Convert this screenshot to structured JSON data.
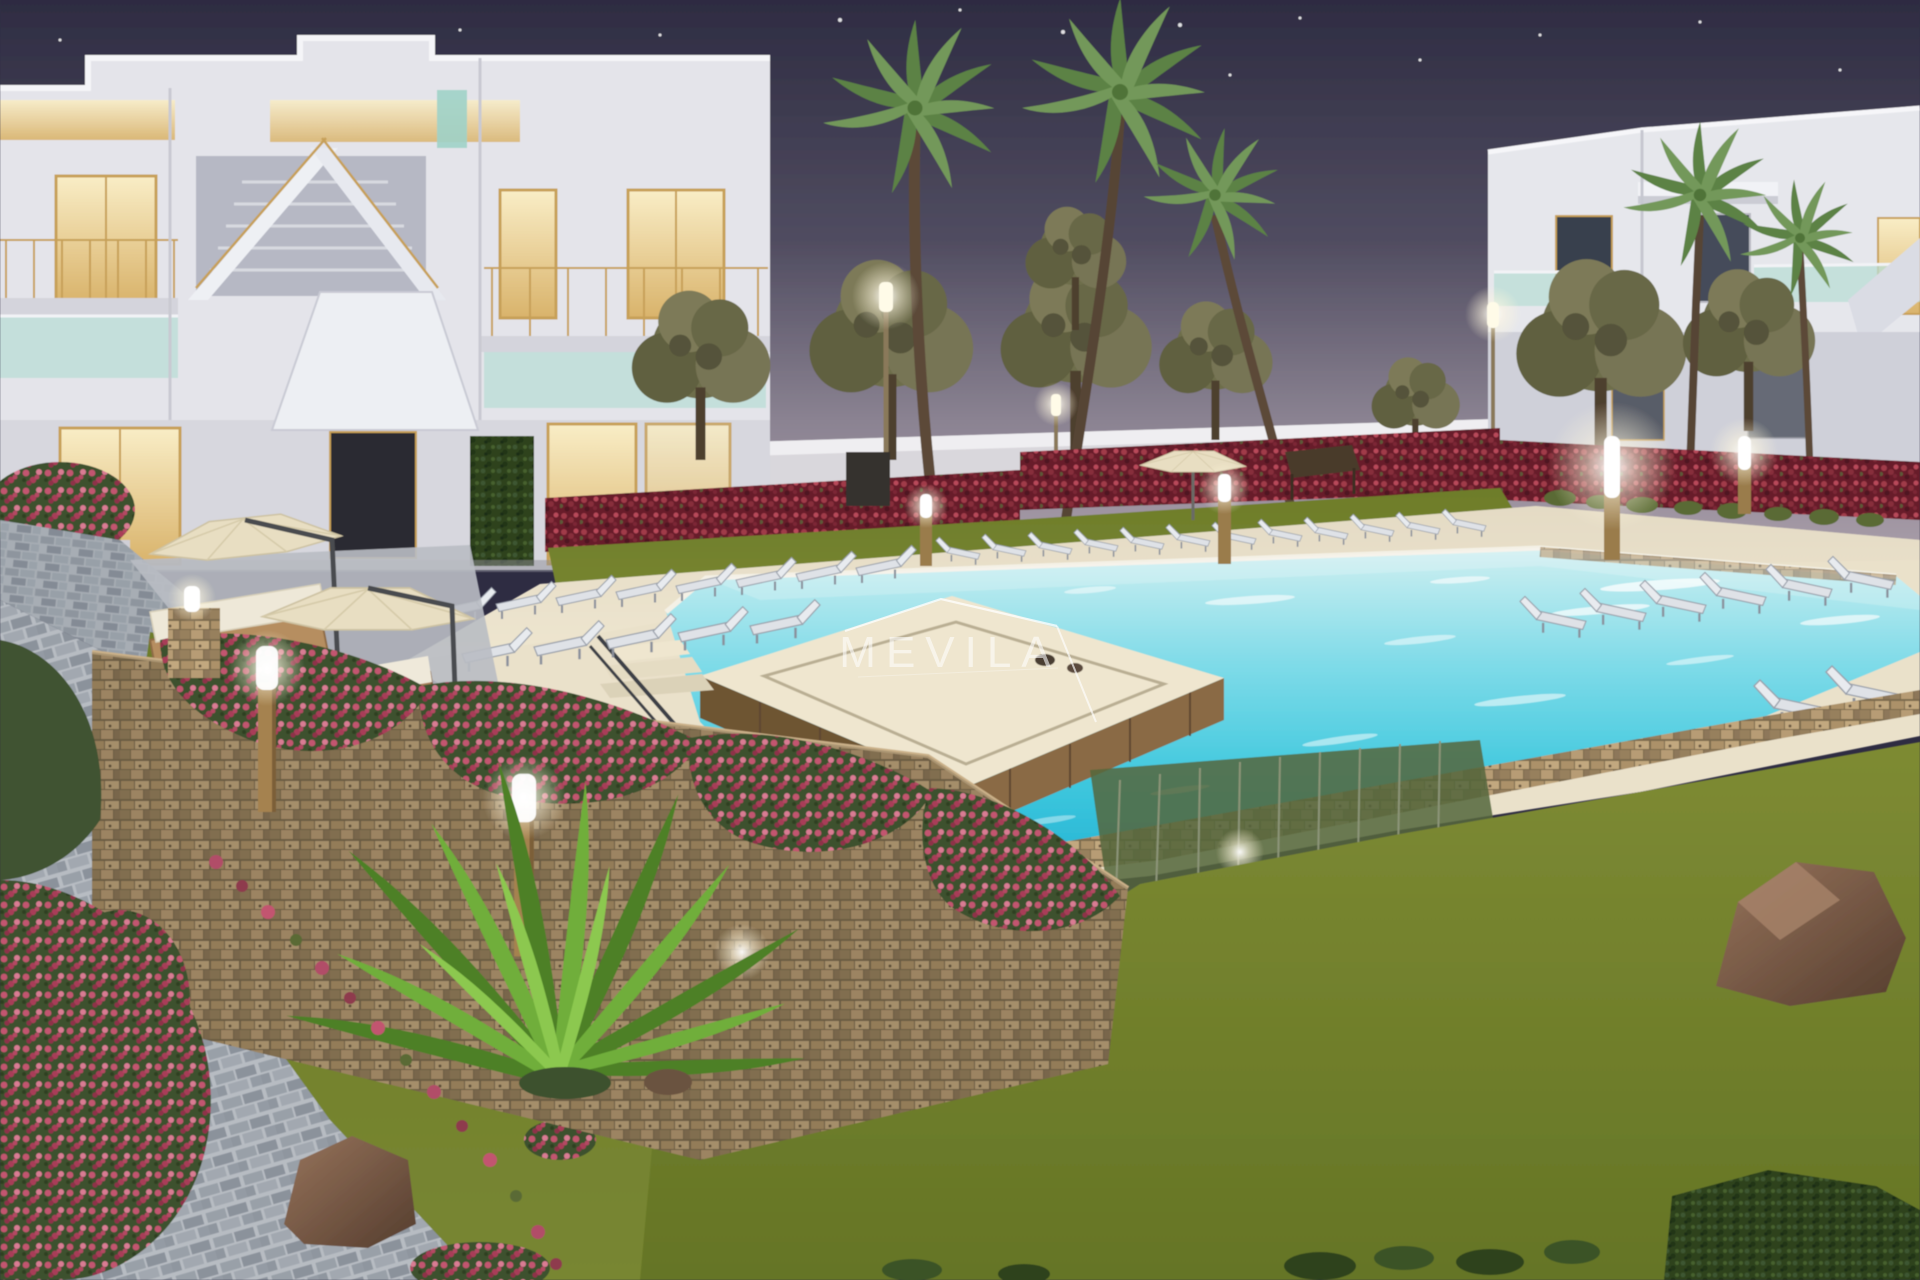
{
  "watermark": {
    "text": "MEVILA"
  },
  "scene": {
    "description": "Dusk 3D architectural render of a Mediterranean residential complex: two white two-storey apartment buildings, communal turquoise pool with raised wooden spa platform, rows of sun loungers, beige parasols, stone planter walls with bougainvillea, palm and pine trees, glowing garden bollard lights, lawns and cobble paths under a dark purple night sky with stars.",
    "colors": {
      "sky_top": "#2e2c42",
      "sky_horizon": "#a59aa6",
      "building_white": "#e7e7ec",
      "window_glow": "#f6e3ae",
      "frame_gold": "#c7a059",
      "glass_teal": "#b9ded6",
      "hedge_red": "#8e2f3c",
      "bougainvillea_pink": "#b4506b",
      "lawn_green": "#75832f",
      "pool_far": "#c9edef",
      "pool_near": "#1fb0d2",
      "deck_cream": "#eae1ca",
      "spa_wood": "#8a6a44",
      "stone_tan": "#b2976f",
      "paver_grey": "#9aa1a9",
      "umbrella_beige": "#e8dec2",
      "lounger_grey": "#dfe2e7",
      "light_warm": "#fff6d8",
      "ivy_dark": "#2e431f",
      "rock_brown": "#8a6a52"
    },
    "elements": {
      "buildings": 2,
      "palm_trees": 5,
      "pine_trees": 8,
      "sun_loungers": 33,
      "parasols": 4,
      "bollard_lights": 7,
      "street_lamps": 3,
      "garden_spotlights": 2,
      "rocks": 3,
      "stars": 18
    }
  }
}
